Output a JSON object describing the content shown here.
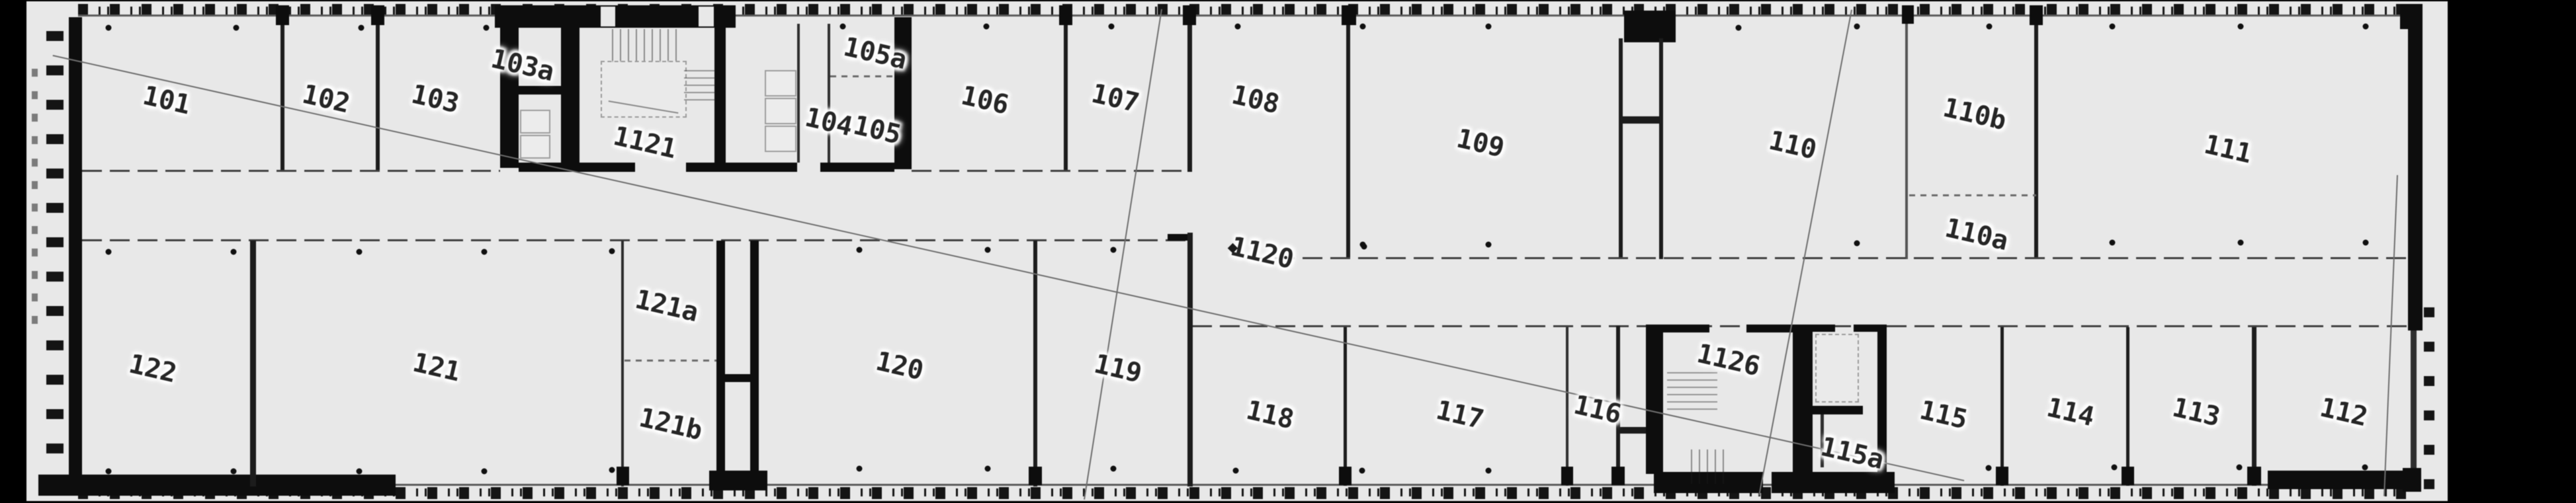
{
  "plan": {
    "type": "floor-plan",
    "colors": {
      "background": "#000000",
      "paper": "#e8e8e8",
      "wall": "#0d0d0d",
      "thin_line": "#5a5a5a",
      "label_text": "#262626",
      "label_halo": "#ffffff"
    },
    "corridor_label": "1120",
    "rooms": [
      {
        "id": "101",
        "label": "101"
      },
      {
        "id": "102",
        "label": "102"
      },
      {
        "id": "103",
        "label": "103"
      },
      {
        "id": "103a",
        "label": "103a"
      },
      {
        "id": "1121",
        "label": "1121"
      },
      {
        "id": "105a",
        "label": "105a"
      },
      {
        "id": "104",
        "label": "104"
      },
      {
        "id": "105",
        "label": "105"
      },
      {
        "id": "106",
        "label": "106"
      },
      {
        "id": "107",
        "label": "107"
      },
      {
        "id": "108",
        "label": "108"
      },
      {
        "id": "109",
        "label": "109"
      },
      {
        "id": "110",
        "label": "110"
      },
      {
        "id": "110b",
        "label": "110b"
      },
      {
        "id": "110a",
        "label": "110a"
      },
      {
        "id": "111",
        "label": "111"
      },
      {
        "id": "1120",
        "label": "1120"
      },
      {
        "id": "122",
        "label": "122"
      },
      {
        "id": "121",
        "label": "121"
      },
      {
        "id": "121a",
        "label": "121a"
      },
      {
        "id": "121b",
        "label": "121b"
      },
      {
        "id": "120",
        "label": "120"
      },
      {
        "id": "119",
        "label": "119"
      },
      {
        "id": "118",
        "label": "118"
      },
      {
        "id": "117",
        "label": "117"
      },
      {
        "id": "116",
        "label": "116"
      },
      {
        "id": "1126",
        "label": "1126"
      },
      {
        "id": "115a",
        "label": "115a"
      },
      {
        "id": "115",
        "label": "115"
      },
      {
        "id": "114",
        "label": "114"
      },
      {
        "id": "113",
        "label": "113"
      },
      {
        "id": "112",
        "label": "112"
      }
    ],
    "column_dots": [
      [
        164,
        42
      ],
      [
        357,
        42
      ],
      [
        546,
        42
      ],
      [
        735,
        42
      ],
      [
        1274,
        40
      ],
      [
        1491,
        40
      ],
      [
        1680,
        40
      ],
      [
        1871,
        40
      ],
      [
        2060,
        40
      ],
      [
        2250,
        40
      ],
      [
        2628,
        42
      ],
      [
        2807,
        40
      ],
      [
        3007,
        40
      ],
      [
        3193,
        40
      ],
      [
        3387,
        40
      ],
      [
        3576,
        40
      ],
      [
        2060,
        370
      ],
      [
        2250,
        370
      ],
      [
        2807,
        368
      ],
      [
        3193,
        367
      ],
      [
        3387,
        367
      ],
      [
        3576,
        367
      ],
      [
        2062,
        373
      ],
      [
        164,
        381
      ],
      [
        353,
        381
      ],
      [
        543,
        381
      ],
      [
        732,
        381
      ],
      [
        925,
        380
      ],
      [
        1299,
        378
      ],
      [
        1493,
        378
      ],
      [
        1683,
        378
      ],
      [
        164,
        713
      ],
      [
        353,
        713
      ],
      [
        543,
        713
      ],
      [
        732,
        713
      ],
      [
        925,
        711
      ],
      [
        1299,
        709
      ],
      [
        1493,
        709
      ],
      [
        1683,
        709
      ],
      [
        1868,
        712
      ],
      [
        2059,
        712
      ],
      [
        2250,
        712
      ],
      [
        3006,
        708
      ],
      [
        3196,
        707
      ],
      [
        3385,
        707
      ],
      [
        3575,
        707
      ]
    ]
  }
}
